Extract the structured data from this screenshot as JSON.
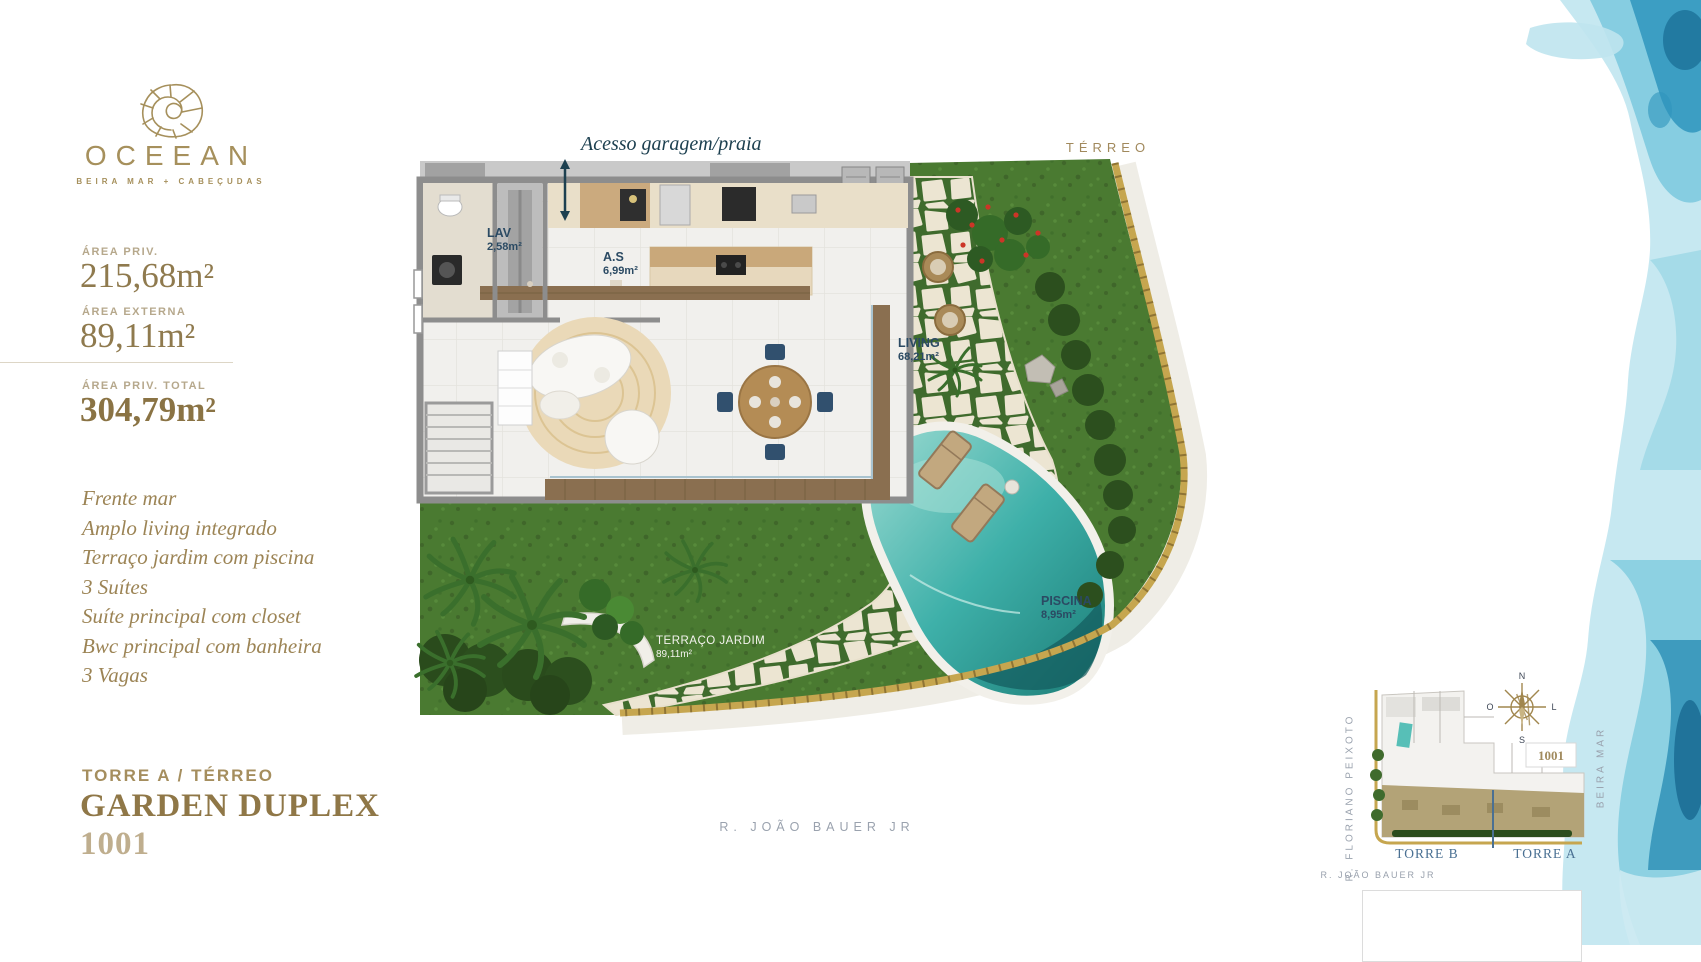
{
  "brand": {
    "name": "OCEEAN",
    "tagline": "BEIRA MAR + CABEÇUDAS",
    "logo_icon": "nautilus-shell-icon",
    "gold": "#a6905c"
  },
  "specs": {
    "area_priv_label": "ÁREA PRIV.",
    "area_priv_value": "215,68m²",
    "area_ext_label": "ÁREA EXTERNA",
    "area_ext_value": "89,11m²",
    "area_total_label": "ÁREA PRIV. TOTAL",
    "area_total_value": "304,79m²"
  },
  "features": [
    "Frente mar",
    "Amplo living integrado",
    "Terraço jardim com piscina",
    "3 Suítes",
    "Suíte principal com closet",
    "Bwc principal com banheira",
    "3 Vagas"
  ],
  "unit": {
    "tower_floor": "TORRE A / TÉRREO",
    "title": "GARDEN DUPLEX",
    "number": "1001"
  },
  "plan": {
    "floor_label": "TÉRREO",
    "access_note": "Acesso garagem/praia",
    "rooms": [
      {
        "name": "LAV",
        "area": "2,58m²"
      },
      {
        "name": "A.S",
        "area": "6,99m²"
      },
      {
        "name": "LIVING",
        "area": "68,21m²"
      },
      {
        "name": "PISCINA",
        "area": "8,95m²"
      },
      {
        "name": "TERRAÇO JARDIM",
        "area": "89,11m²"
      }
    ],
    "street_label": "R. JOÃO BAUER JR"
  },
  "minimap": {
    "street_left": "R. FLORIANO PEIXOTO",
    "street_bottom": "R. JOÃO BAUER JR",
    "street_right": "BEIRA MAR",
    "tower_b_label": "TORRE B",
    "tower_a_label": "TORRE A",
    "unit_badge": "1001",
    "compass": {
      "n": "N",
      "s": "S",
      "l": "L",
      "o": "O"
    }
  },
  "colors": {
    "gold_text": "#a6905c",
    "dark_gold": "#8f7747",
    "navy_label": "#2b4a63",
    "teal_note": "#1d4050",
    "grass": "#4a7a31",
    "hedge": "#2c4d1d",
    "pool": "#3eb0a9",
    "stone": "#ece5d2",
    "boundary_gold": "#c6a64f",
    "street_gray": "#9aa2ae",
    "watercolor_light": "#c6e8f1",
    "watercolor_mid": "#7ecadf",
    "watercolor_dark": "#2f95bd"
  }
}
